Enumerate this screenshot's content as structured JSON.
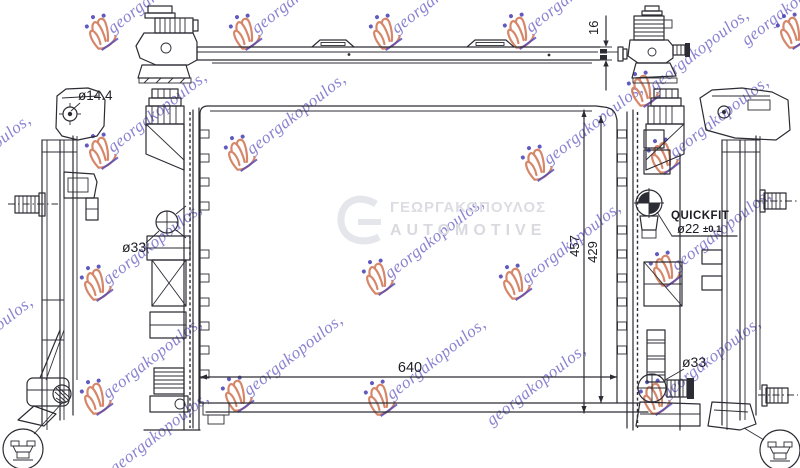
{
  "dimensions": {
    "hole": "ø14.4",
    "top_height": "16",
    "inlet": "ø33",
    "total_height": "457",
    "core_height": "429",
    "quickfit_label": "QUICKFIT",
    "quickfit_size": "ø22",
    "quickfit_tol": "±0.1",
    "outlet": "ø33",
    "core_width": "640"
  },
  "watermark": {
    "text": "georgakopoulos,",
    "text_color": "#6a60c4",
    "crown_stroke": "#cf7250",
    "crown_dot": "#5048b8",
    "angle_deg": -38,
    "crowns": [
      [
        101,
        31
      ],
      [
        245,
        31
      ],
      [
        385,
        31
      ],
      [
        519,
        30
      ],
      [
        792,
        30
      ],
      [
        643,
        88
      ],
      [
        101,
        150
      ],
      [
        240,
        152
      ],
      [
        537,
        162
      ],
      [
        663,
        155
      ],
      [
        96,
        282
      ],
      [
        378,
        276
      ],
      [
        515,
        281
      ],
      [
        665,
        268
      ],
      [
        96,
        396
      ],
      [
        237,
        393
      ],
      [
        380,
        397
      ],
      [
        655,
        396
      ]
    ],
    "texts": [
      [
        116,
        38
      ],
      [
        260,
        38
      ],
      [
        400,
        38
      ],
      [
        534,
        37
      ],
      [
        658,
        95
      ],
      [
        116,
        157
      ],
      [
        255,
        159
      ],
      [
        552,
        169
      ],
      [
        678,
        162
      ],
      [
        111,
        289
      ],
      [
        393,
        283
      ],
      [
        530,
        288
      ],
      [
        680,
        275
      ],
      [
        111,
        403
      ],
      [
        252,
        400
      ],
      [
        395,
        404
      ],
      [
        670,
        403
      ],
      [
        -88,
        72
      ],
      [
        -60,
        200
      ],
      [
        -58,
        382
      ],
      [
        750,
        50
      ],
      [
        118,
        478
      ],
      [
        495,
        430
      ]
    ],
    "center_logo": {
      "line1": "ΓΕΩΡΓΑΚΟΠΟΥΛΟΣ",
      "line2": "AUTOMOTIVE"
    }
  }
}
